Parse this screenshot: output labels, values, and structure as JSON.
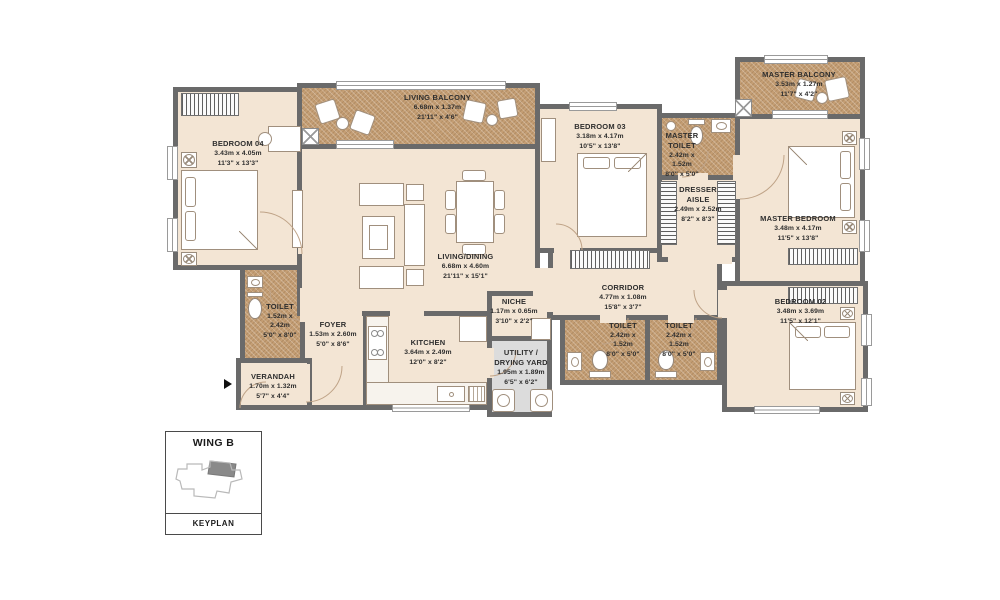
{
  "rooms": {
    "bedroom04": {
      "name": "BEDROOM 04",
      "dim_m": "3.43m x 4.05m",
      "dim_ft": "11'3\" x 13'3\""
    },
    "living_balcony": {
      "name": "LIVING BALCONY",
      "dim_m": "6.68m x 1.37m",
      "dim_ft": "21'11\" x 4'6\""
    },
    "living_dining": {
      "name": "LIVING/DINING",
      "dim_m": "6.68m x 4.60m",
      "dim_ft": "21'11\" x 15'1\""
    },
    "bedroom03": {
      "name": "BEDROOM 03",
      "dim_m": "3.18m x 4.17m",
      "dim_ft": "10'5\" x 13'8\""
    },
    "master_toilet": {
      "name": "MASTER TOILET",
      "dim_m": "2.42m x 1.52m",
      "dim_ft": "8'0\" x 5'0\""
    },
    "dresser_aisle": {
      "name": "DRESSER AISLE",
      "dim_m": "2.49m x 2.52m",
      "dim_ft": "8'2\" x 8'3\""
    },
    "master_balcony": {
      "name": "MASTER BALCONY",
      "dim_m": "3.53m x 1.27m",
      "dim_ft": "11'7\" x 4'2\""
    },
    "master_bedroom": {
      "name": "MASTER BEDROOM",
      "dim_m": "3.48m x 4.17m",
      "dim_ft": "11'5\" x 13'8\""
    },
    "bedroom02": {
      "name": "BEDROOM 02",
      "dim_m": "3.48m x 3.69m",
      "dim_ft": "11'5\" x 12'1\""
    },
    "corridor": {
      "name": "CORRIDOR",
      "dim_m": "4.77m x 1.08m",
      "dim_ft": "15'8\" x 3'7\""
    },
    "toilet_corridor_1": {
      "name": "TOILET",
      "dim_m": "2.42m x 1.52m",
      "dim_ft": "8'0\" x 5'0\""
    },
    "toilet_corridor_2": {
      "name": "TOILET",
      "dim_m": "2.42m x 1.52m",
      "dim_ft": "8'0\" x 5'0\""
    },
    "toilet_bed04": {
      "name": "TOILET",
      "dim_m": "1.52m x 2.42m",
      "dim_ft": "5'0\" x 8'0\""
    },
    "foyer": {
      "name": "FOYER",
      "dim_m": "1.53m x 2.60m",
      "dim_ft": "5'0\" x 8'6\""
    },
    "verandah": {
      "name": "VERANDAH",
      "dim_m": "1.70m x 1.32m",
      "dim_ft": "5'7\" x 4'4\""
    },
    "kitchen": {
      "name": "KITCHEN",
      "dim_m": "3.64m x 2.49m",
      "dim_ft": "12'0\" x 8'2\""
    },
    "niche": {
      "name": "NICHE",
      "dim_m": "1.17m x 0.65m",
      "dim_ft": "3'10\" x 2'2\""
    },
    "utility": {
      "name": "UTILITY / DRYING YARD",
      "dim_m": "1.95m x 1.89m",
      "dim_ft": "6'5\" x 6'2\""
    }
  },
  "keyplan": {
    "title": "WING B",
    "caption": "KEYPLAN"
  },
  "colors": {
    "wall": "#6a6a6a",
    "floor": "#f3e5d4",
    "balcony_floor": "#c49e74",
    "utility_floor": "#dcdcdc",
    "text": "#2e2e2e"
  }
}
